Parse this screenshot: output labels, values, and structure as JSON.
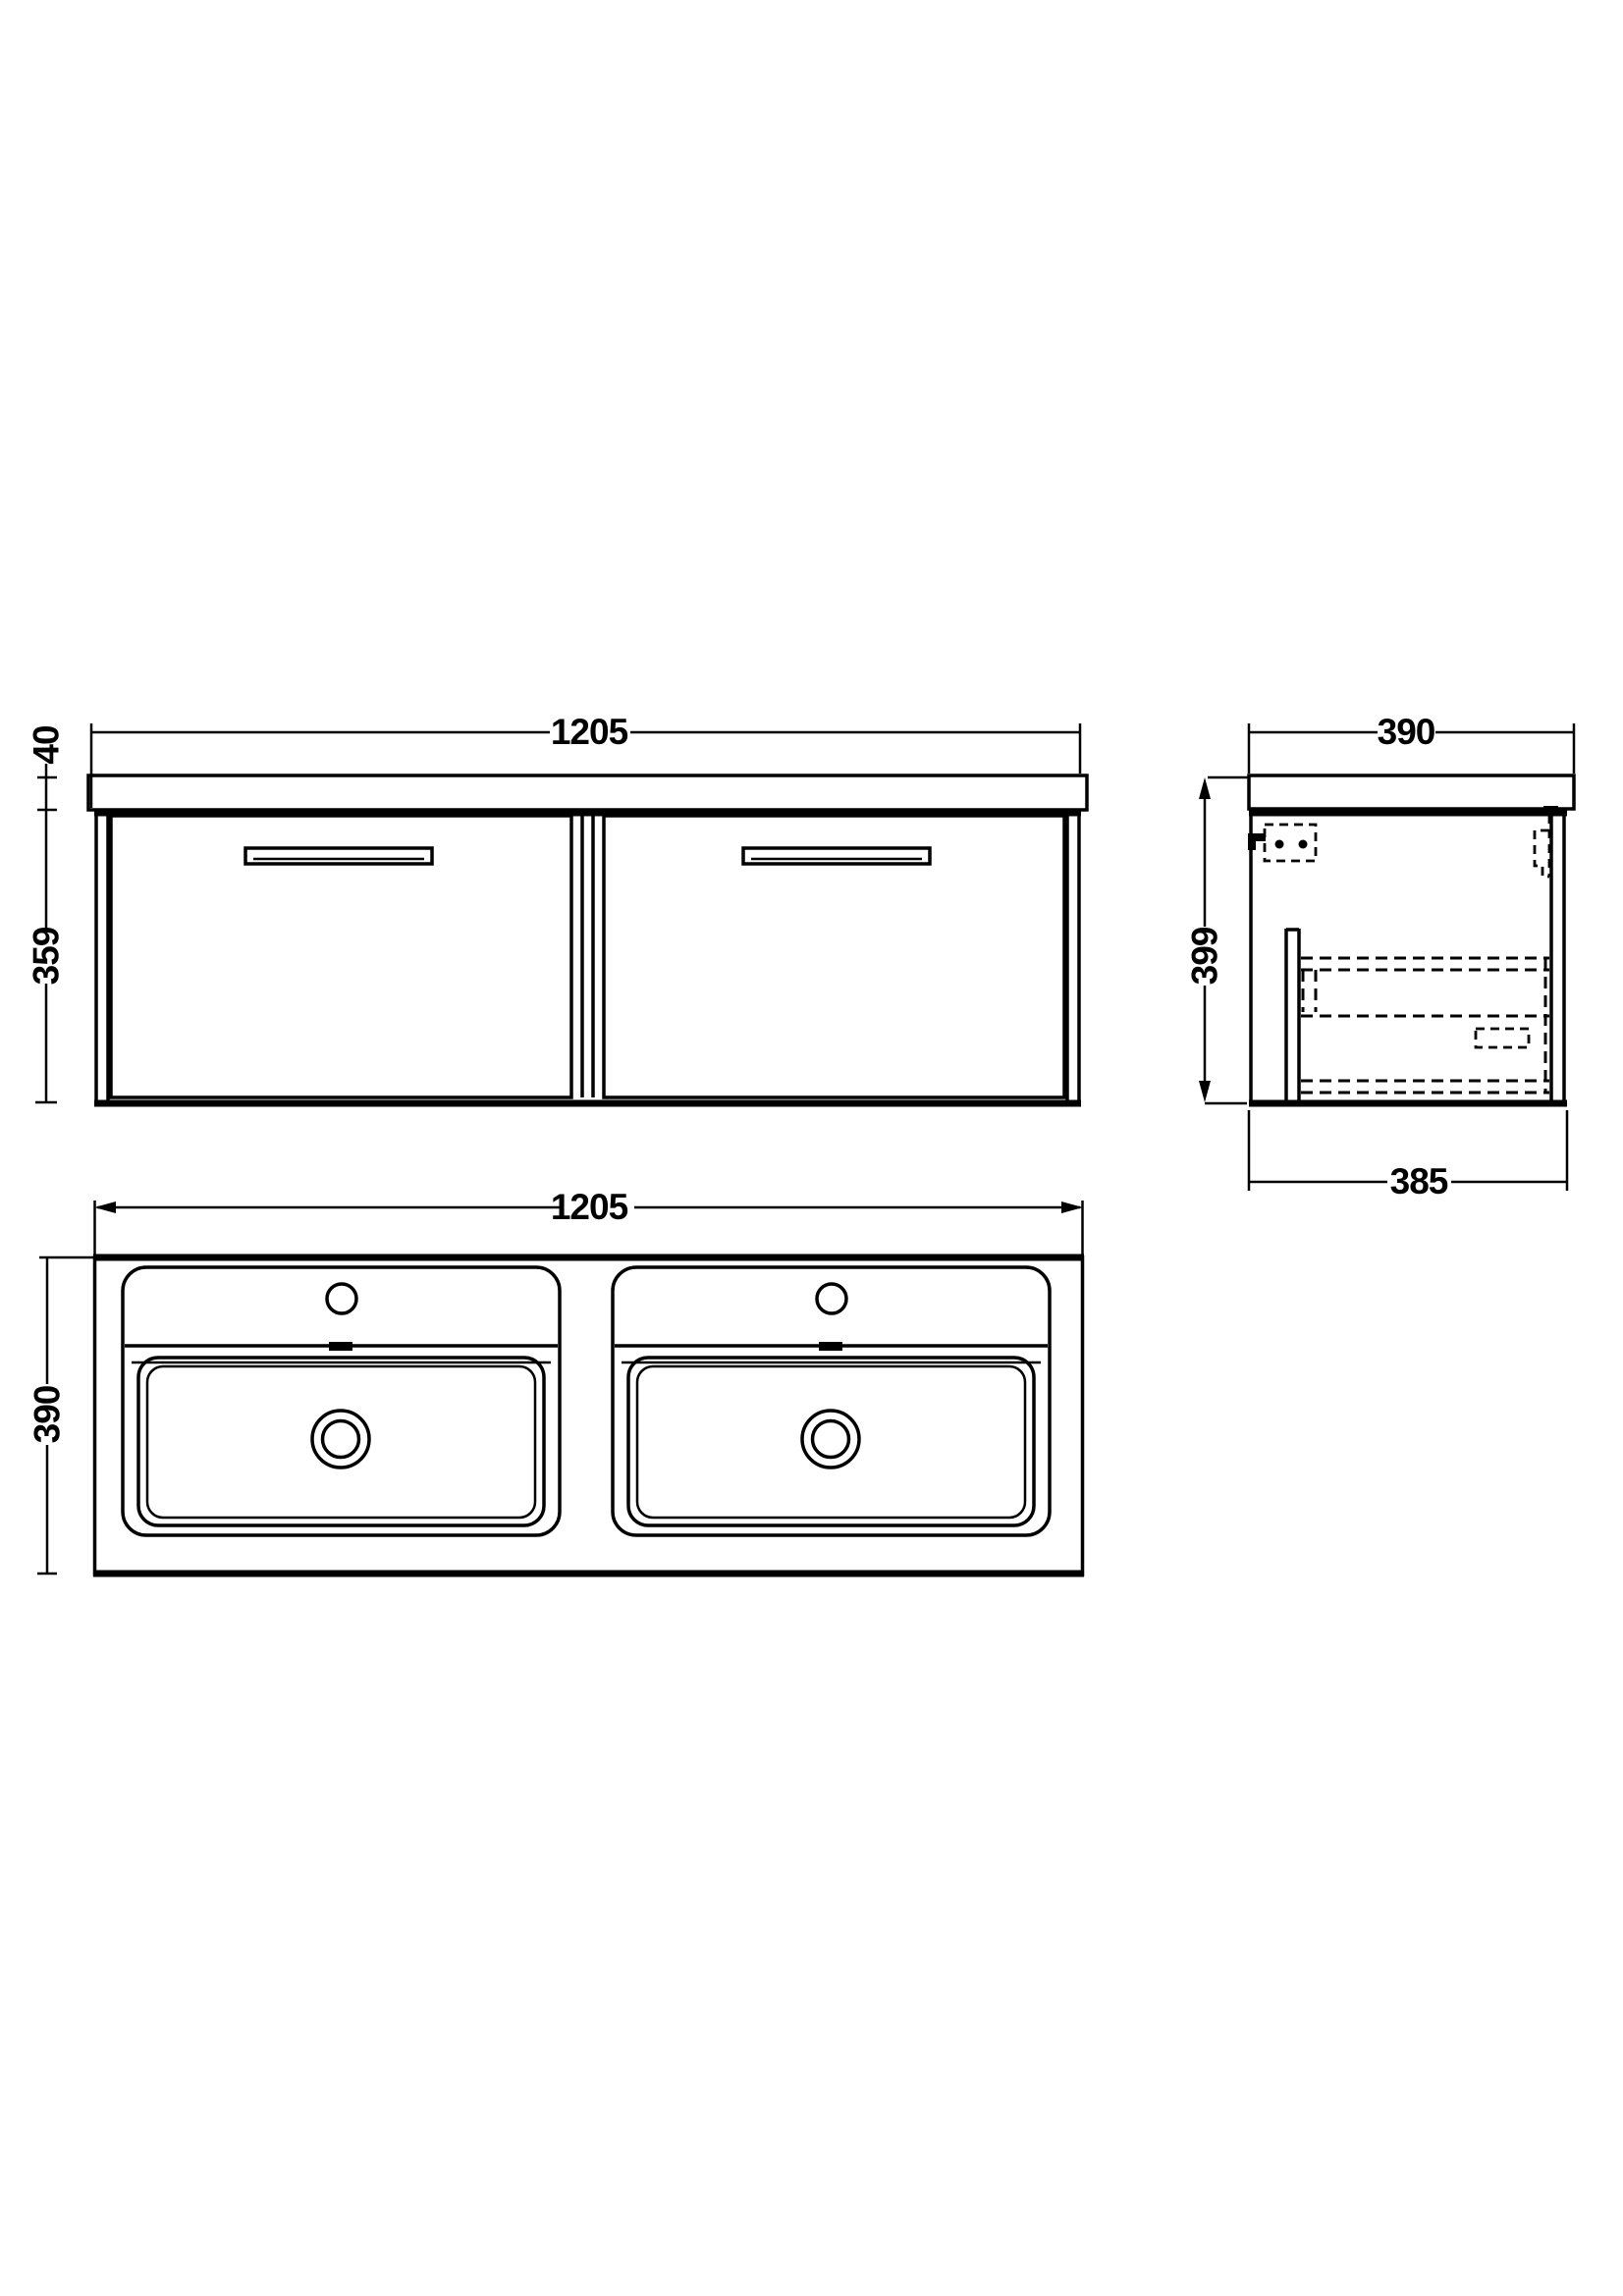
{
  "colors": {
    "background": "#ffffff",
    "line": "#000000"
  },
  "views": {
    "front": {
      "width_mm": "1205",
      "worktop_thickness_mm": "40",
      "cabinet_height_mm": "359"
    },
    "side": {
      "depth_mm": "390",
      "overall_height_mm": "399",
      "cabinet_depth_mm": "385"
    },
    "plan": {
      "width_mm": "1205",
      "depth_mm": "390"
    }
  }
}
